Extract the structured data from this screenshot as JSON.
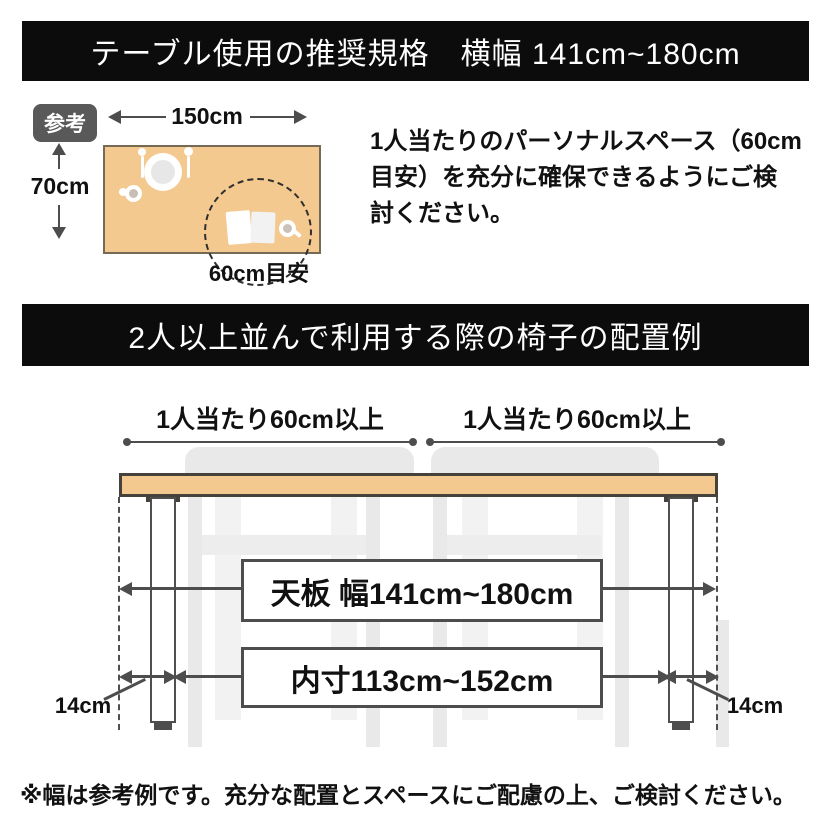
{
  "banners": {
    "spec_title": "テーブル使用の推奨規格　横幅 141cm~180cm",
    "layout_title": "2人以上並んで利用する際の椅子の配置例"
  },
  "reference": {
    "badge_label": "参考",
    "table_width_label": "150cm",
    "table_depth_label": "70cm",
    "personal_space_label": "60cm目安",
    "note_lines": [
      "1人当たりのパーソナルスペース（60cm",
      "目安）を充分に確保できるようにご検",
      "討ください。"
    ]
  },
  "layout_example": {
    "per_person_label_left": "1人当たり60cm以上",
    "per_person_label_right": "1人当たり60cm以上",
    "tabletop_width_label": "天板 幅141cm~180cm",
    "inner_width_label": "内寸113cm~152cm",
    "leg_inset_label_left": "14cm",
    "leg_inset_label_right": "14cm"
  },
  "footer_note": "※幅は参考例です。充分な配置とスペースにご配慮の上、ご検討ください。",
  "colors": {
    "banner_bg": "#0c0c0c",
    "wood": "#f3c98f",
    "arrow_gray": "#4d4d4d",
    "chair_gray": "#e9e9e9",
    "badge_gray": "#595959"
  }
}
